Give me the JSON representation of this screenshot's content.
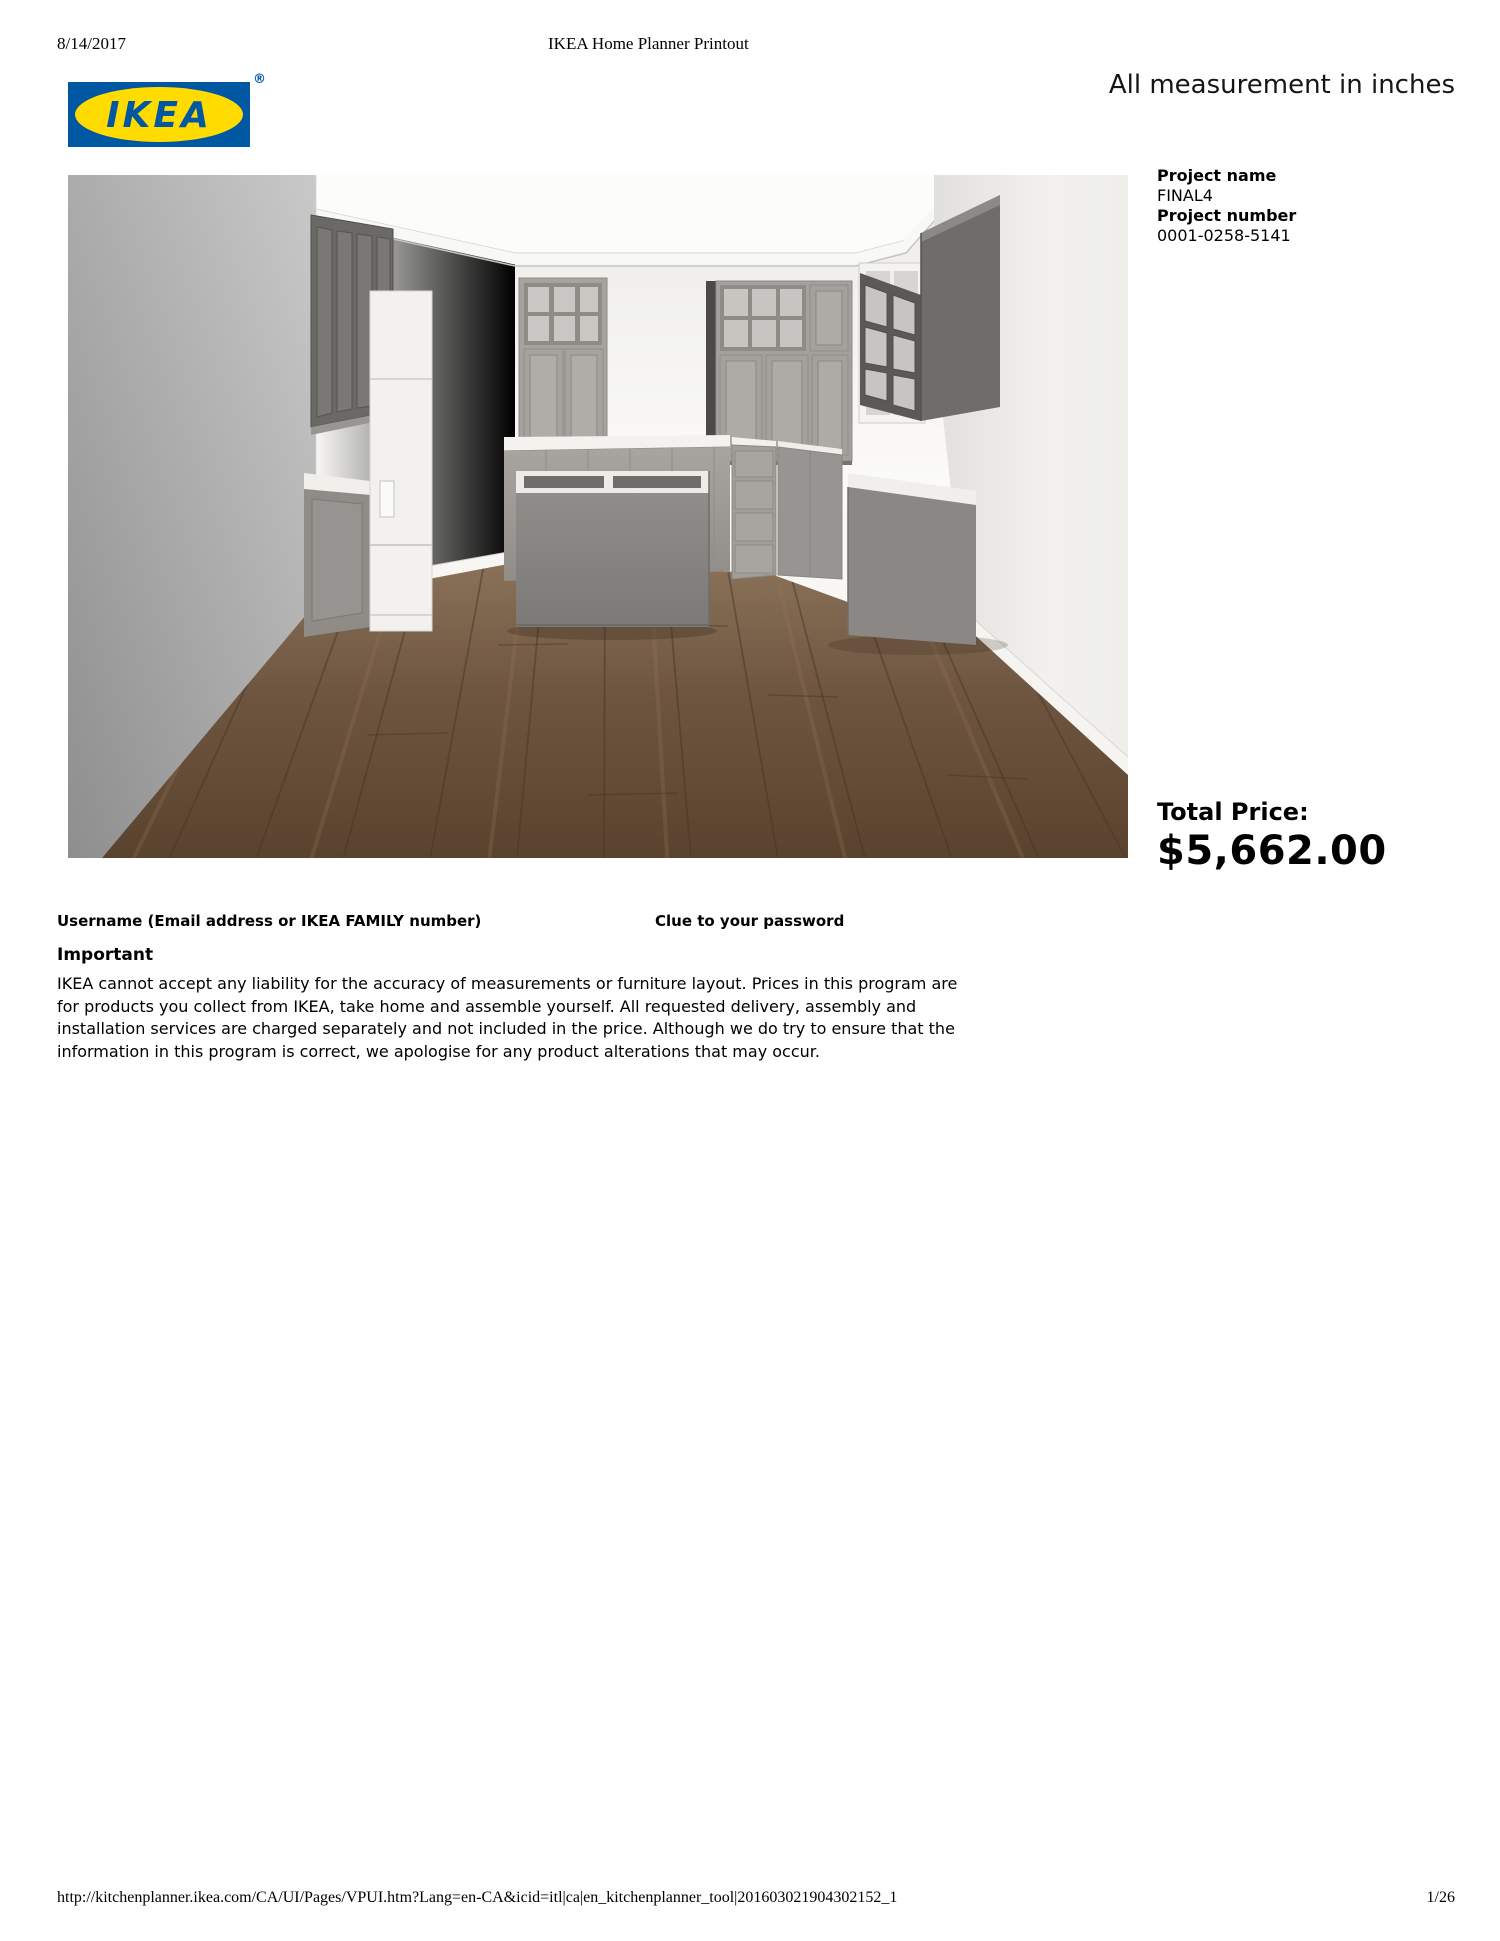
{
  "header": {
    "date": "8/14/2017",
    "title": "IKEA Home Planner Printout",
    "measurement_note": "All measurement in inches"
  },
  "logo": {
    "text": "IKEA",
    "registered_mark": "®",
    "colors": {
      "blue": "#0058A3",
      "yellow": "#FFDB00"
    }
  },
  "project": {
    "name_label": "Project name",
    "name_value": "FINAL4",
    "number_label": "Project number",
    "number_value": "0001-0258-5141"
  },
  "pricing": {
    "label": "Total Price:",
    "value": "$5,662.00"
  },
  "credentials": {
    "username_label": "Username (Email address or IKEA FAMILY number)",
    "password_clue_label": "Clue to your password"
  },
  "important": {
    "heading": "Important",
    "lines": [
      "IKEA cannot accept any liability for the accuracy of measurements or furniture layout. Prices in this program are",
      "for products you collect from IKEA, take home and assemble yourself. All requested delivery, assembly and",
      "installation services are charged separately and not included in the price. Although we do try to ensure that the",
      "information in this program is correct, we apologise for any product alterations that may occur."
    ]
  },
  "footer": {
    "url": "http://kitchenplanner.ikea.com/CA/UI/Pages/VPUI.htm?Lang=en-CA&icid=itl|ca|en_kitchenplanner_tool|201603021904302152_1",
    "page_indicator": "1/26"
  },
  "render": {
    "description": "3D preview of kitchen with gray cabinets, island and wood floor",
    "colors": {
      "wall_gray": "#a9a9a9",
      "wall_white": "#f7f6f3",
      "cabinet_gray": "#a7a4a0",
      "cabinet_dark": "#6b6a67",
      "floor_brown": "#6b5138"
    }
  }
}
